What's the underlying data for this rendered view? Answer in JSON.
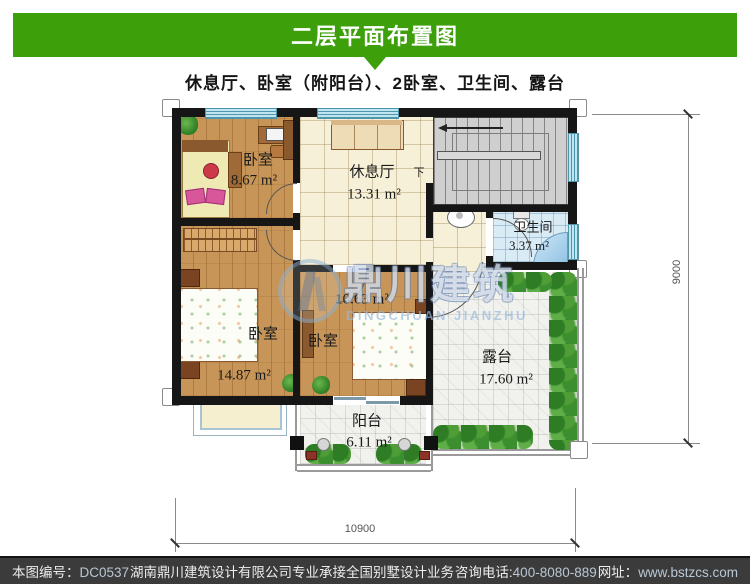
{
  "header": {
    "title": "二层平面布置图"
  },
  "subtitle": "休息厅、卧室（附阳台）、2卧室、卫生间、露台",
  "plan": {
    "rooms": {
      "bedroom_top_left": {
        "name": "卧室",
        "area": "8.67 m²"
      },
      "lounge": {
        "name": "休息厅",
        "area": "13.31 m²"
      },
      "bathroom": {
        "name": "卫生间",
        "area": "3.37 m²"
      },
      "bedroom_bottom_left": {
        "name": "卧室",
        "area": "14.87 m²"
      },
      "bedroom_middle": {
        "name": "卧室",
        "area": "10.63 m²"
      },
      "terrace": {
        "name": "露台",
        "area": "17.60 m²"
      },
      "balcony": {
        "name": "阳台",
        "area": "6.11 m²"
      }
    },
    "stairs_down_label": "下",
    "dimensions": {
      "bottom": "10900",
      "right": "9000"
    }
  },
  "watermark": {
    "cn": "鼎川建筑",
    "en": "DINGCHUAN JIANZHU"
  },
  "footer": {
    "id_label": "本图编号：",
    "id_value": "DC0537",
    "company": "湖南鼎川建筑设计有限公司专业承接全国别墅设计业务",
    "phone_label": "咨询电话:",
    "phone_value": "400-8080-889",
    "web_label": "网址：",
    "web_value": "www.bstzcs.com"
  },
  "colors": {
    "accent_green": "#3da00b",
    "footer_bg": "#3b3b3b",
    "wall": "#161616"
  }
}
